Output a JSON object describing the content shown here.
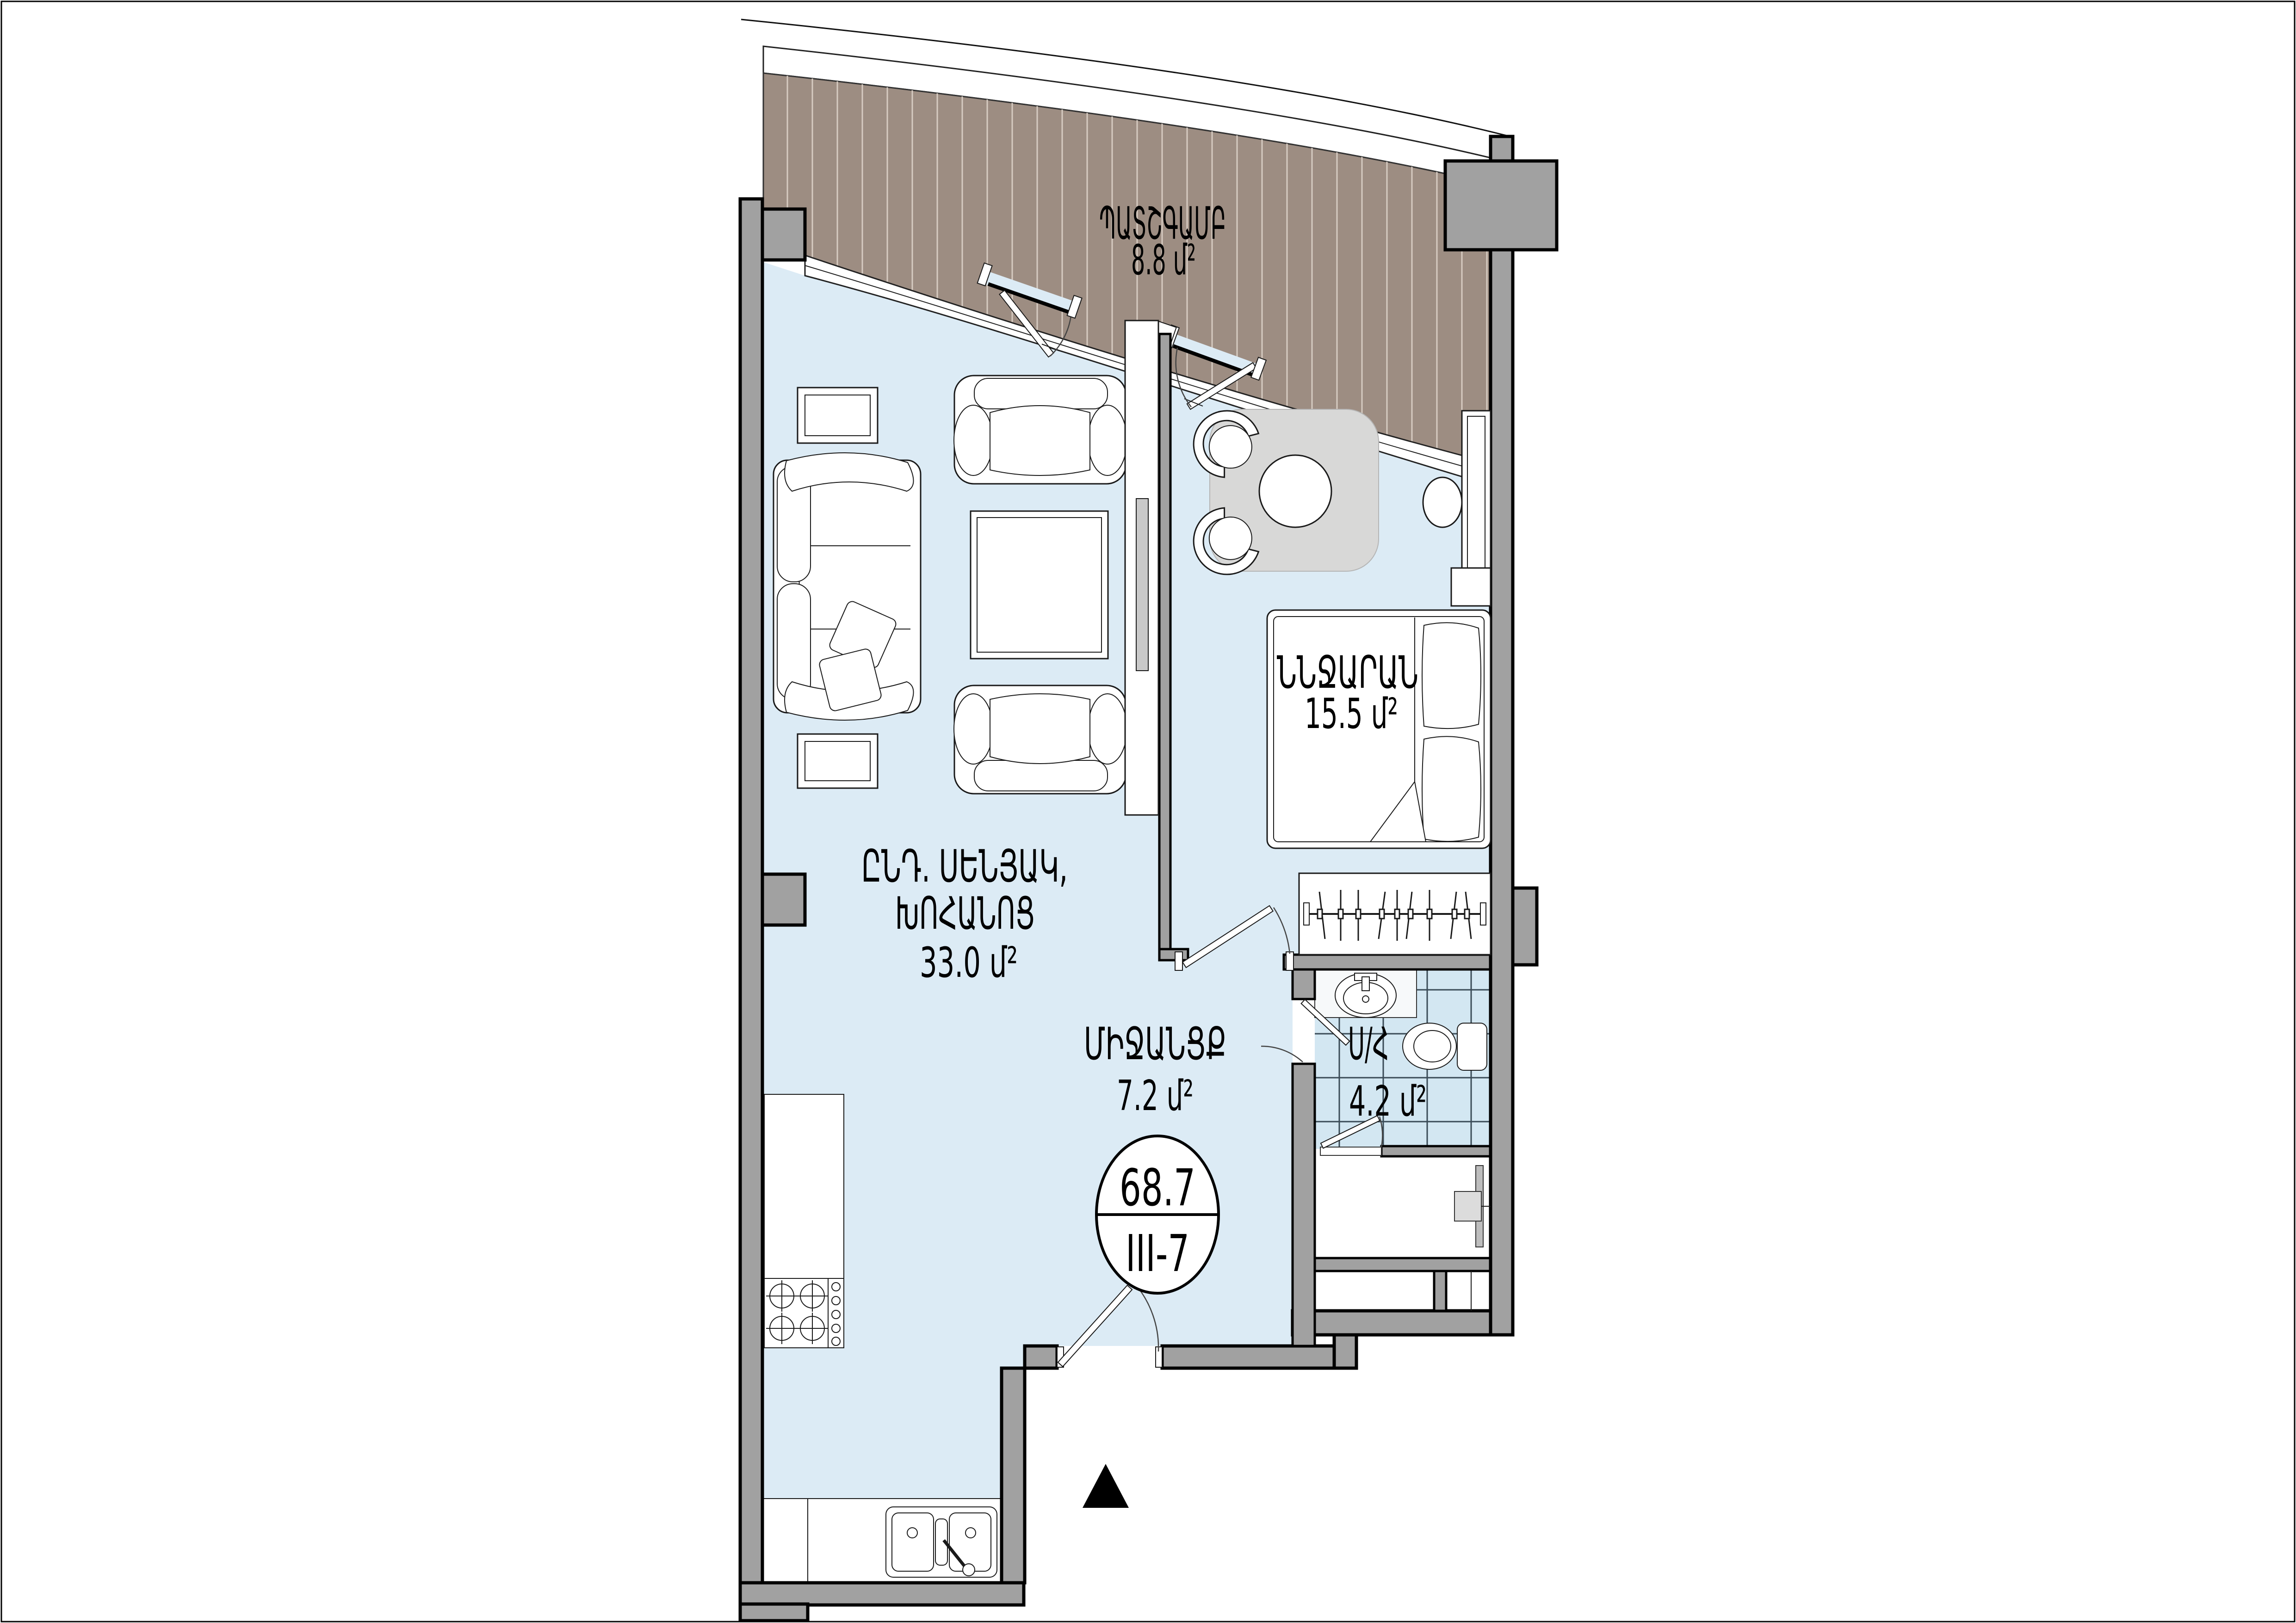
{
  "plan": {
    "colors": {
      "floor": "#dcebf5",
      "wall": "#a1a1a1",
      "deck": "#9d8d82",
      "deck-stripe": "#d6cbc1",
      "tile": "#d3e7f2",
      "tile-line": "#3a4b57",
      "rug": "#d8d8d7",
      "ink": "#000000",
      "paper": "#ffffff"
    },
    "rooms": [
      {
        "id": "balcony",
        "name": "ՊԱՏՇԳԱՄԲ",
        "area": "8.8 մ²"
      },
      {
        "id": "living",
        "name_line1": "ԸՆԴ. ՍԵՆՅԱԿ,",
        "name_line2": "ԽՈՀԱՆՈՑ",
        "area": "33.0 մ²"
      },
      {
        "id": "bedroom",
        "name": "ՆՆՋԱՐԱՆ",
        "area": "15.5 մ²"
      },
      {
        "id": "hallway",
        "name": "ՄԻՋԱՆՑՔ",
        "area": "7.2 մ²"
      },
      {
        "id": "bathroom",
        "name": "Ս/Հ",
        "area": "4.2 մ²"
      }
    ],
    "stamp": {
      "total_area": "68.7",
      "unit_code": "III-7"
    }
  }
}
